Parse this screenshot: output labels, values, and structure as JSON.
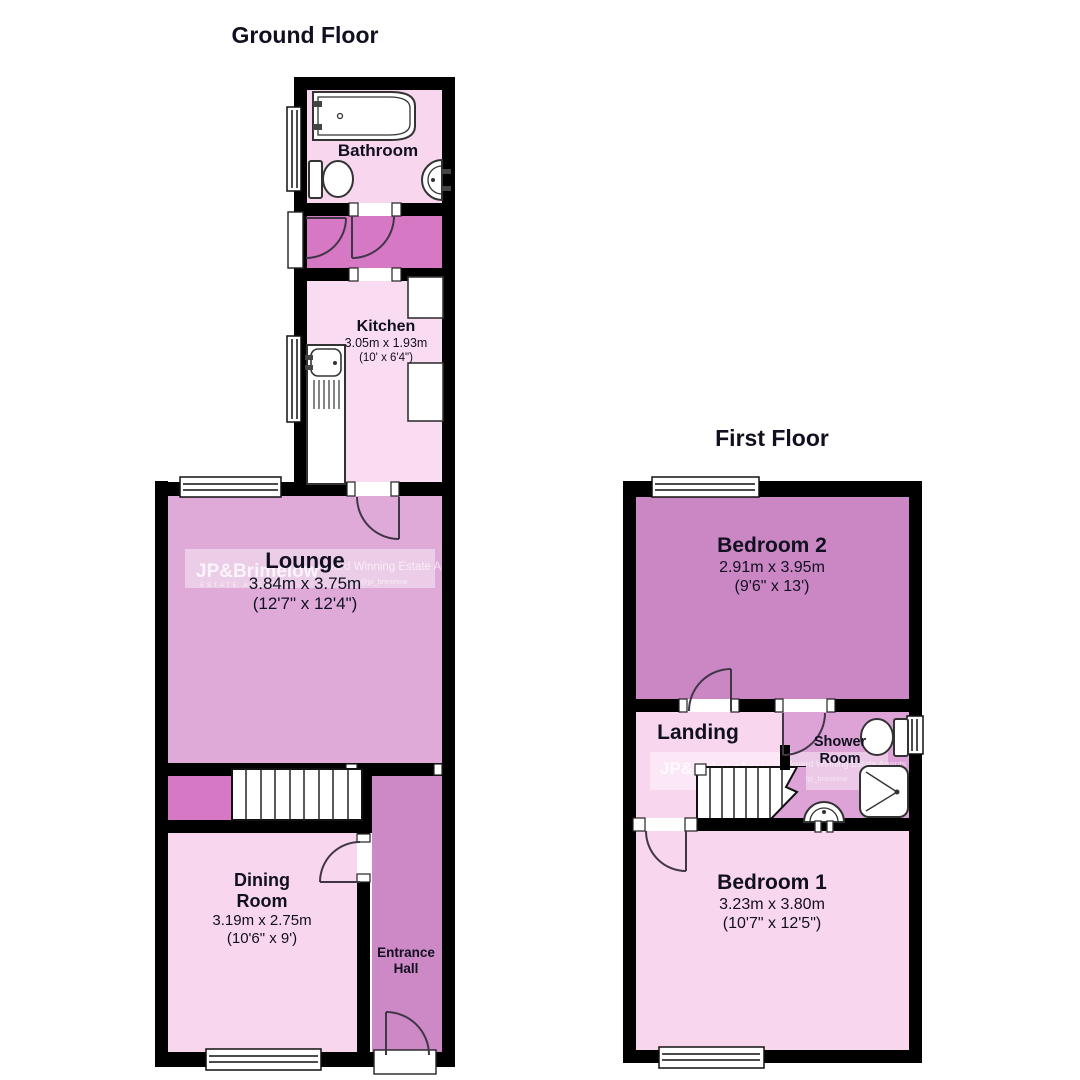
{
  "floors": [
    {
      "title": "Ground Floor"
    },
    {
      "title": "First Floor"
    }
  ],
  "rooms": {
    "bathroom": {
      "name": "Bathroom"
    },
    "kitchen": {
      "name": "Kitchen",
      "dims_m": "3.05m x 1.93m",
      "dims_ft": "(10' x 6'4\")"
    },
    "lounge": {
      "name": "Lounge",
      "dims_m": "3.84m x 3.75m",
      "dims_ft": "(12'7\" x 12'4\")"
    },
    "dining": {
      "name": "Dining Room",
      "dims_m": "3.19m x 2.75m",
      "dims_ft": "(10'6\" x 9')"
    },
    "hall": {
      "name": "Entrance Hall"
    },
    "bedroom2": {
      "name": "Bedroom 2",
      "dims_m": "2.91m x 3.95m",
      "dims_ft": "(9'6\" x 13')"
    },
    "landing": {
      "name": "Landing"
    },
    "shower": {
      "name": "Shower Room"
    },
    "bedroom1": {
      "name": "Bedroom 1",
      "dims_m": "3.23m x 3.80m",
      "dims_ft": "(10'7\" x 12'5\")"
    }
  },
  "watermark": {
    "brand": "JP&Brimelow",
    "sub": "ESTATE AGENTS",
    "tagline": "Award Winning Estate Agents",
    "handle": "@jp_brimelow"
  },
  "icons": {
    "bath": "bath-icon",
    "toilet": "toilet-icon",
    "sink": "sink-icon",
    "kitchen_sink": "kitchen-sink-icon",
    "shower_tray": "shower-tray-icon",
    "stairs": "stairs-icon",
    "window": "window-icon",
    "door_arc": "door-swing-icon"
  },
  "colors": {
    "wall": "#000000",
    "room_light": "#f8d6ee",
    "kitchen": "#fadcf2",
    "lounge": "#dfa9d8",
    "hall": "#cd88c6",
    "lobby": "#d778c5",
    "bedroom2": "#cb86c4",
    "shower": "#dda3d6",
    "fixture": "#ffffff",
    "text": "#101020"
  }
}
